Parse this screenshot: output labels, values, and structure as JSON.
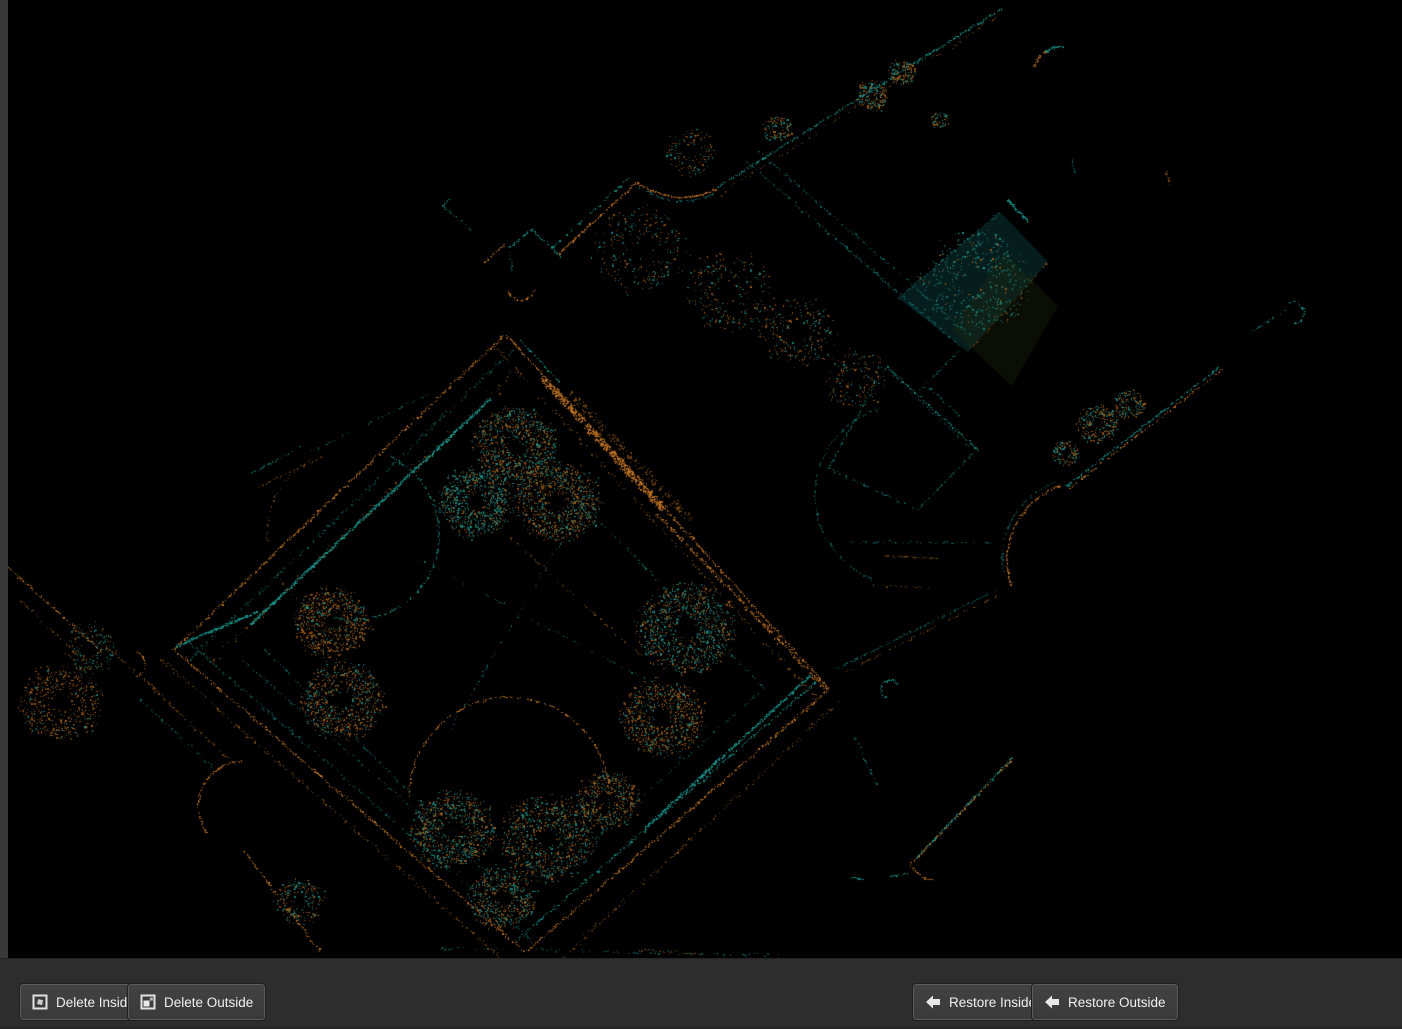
{
  "window": {
    "width": 1402,
    "height": 1029,
    "background": "#000000"
  },
  "chrome": {
    "left_strip_color": "#383838",
    "bottom_bar_color": "#2d2d2d"
  },
  "toolbar": {
    "buttons": [
      {
        "id": "delete-inside",
        "label": "Delete Inside",
        "icon": "segment-delete-inside-icon",
        "x": 20
      },
      {
        "id": "delete-outside",
        "label": "Delete Outside",
        "icon": "segment-delete-outside-icon",
        "x": 128
      },
      {
        "id": "restore-inside",
        "label": "Restore Inside",
        "icon": "arrow-left-icon",
        "x": 913
      },
      {
        "id": "restore-outside",
        "label": "Restore Outside",
        "icon": "arrow-left-icon",
        "x": 1032
      }
    ]
  },
  "viewport": {
    "description": "Top-down LiDAR point cloud of a courtyard building complex, points colored teal and orange on black",
    "accent_teal": "#17988f",
    "accent_orange": "#c07322"
  },
  "scene": {
    "seed": 1337,
    "palette": {
      "T": "#17988f",
      "t": "#0d6966",
      "O": "#c07322",
      "o": "#7c4a12",
      "blob_teal": "#1b8e86",
      "blob_orange": "#a55f16"
    },
    "fills": [
      {
        "poly": [
          [
            1000,
            212
          ],
          [
            1048,
            262
          ],
          [
            968,
            352
          ],
          [
            898,
            298
          ]
        ],
        "color": "rgba(10,55,52,0.55)"
      },
      {
        "poly": [
          [
            1004,
            252
          ],
          [
            1058,
            306
          ],
          [
            1012,
            386
          ],
          [
            952,
            330
          ]
        ],
        "color": "rgba(35,45,18,0.30)"
      }
    ],
    "strokes": [
      [
        "L",
        503,
        336,
        174,
        649,
        "O",
        1,
        0.7,
        1.5
      ],
      [
        "L",
        513,
        349,
        188,
        661,
        "t",
        1,
        0.4,
        2.5
      ],
      [
        "L",
        490,
        399,
        251,
        624,
        "T",
        2,
        0.95,
        0.8
      ],
      [
        "L",
        176,
        646,
        257,
        612,
        "T",
        2,
        0.9,
        0.8
      ],
      [
        "L",
        522,
        365,
        205,
        668,
        "o",
        1,
        0.25,
        5
      ],
      [
        "L",
        506,
        334,
        829,
        689,
        "O",
        1,
        0.75,
        1.2
      ],
      [
        "L",
        542,
        377,
        663,
        509,
        "O",
        6,
        0.8,
        2.5
      ],
      [
        "L",
        570,
        392,
        690,
        520,
        "o",
        4,
        0.45,
        4
      ],
      [
        "L",
        655,
        512,
        827,
        690,
        "O",
        2,
        0.6,
        2
      ],
      [
        "L",
        494,
        346,
        816,
        698,
        "o",
        1,
        0.3,
        3
      ],
      [
        "L",
        518,
        338,
        560,
        383,
        "T",
        1,
        0.5,
        1
      ],
      [
        "L",
        829,
        689,
        527,
        951,
        "O",
        1.2,
        0.7,
        1.5
      ],
      [
        "L",
        817,
        681,
        516,
        941,
        "T",
        1.2,
        0.55,
        1.5
      ],
      [
        "L",
        840,
        701,
        562,
        958,
        "o",
        1,
        0.4,
        2.5
      ],
      [
        "L",
        810,
        676,
        645,
        828,
        "T",
        2,
        0.85,
        0.8
      ],
      [
        "L",
        173,
        649,
        524,
        951,
        "O",
        1.2,
        0.7,
        1.5
      ],
      [
        "L",
        186,
        640,
        532,
        941,
        "t",
        1,
        0.45,
        2
      ],
      [
        "L",
        161,
        659,
        500,
        957,
        "o",
        1,
        0.45,
        2.5
      ],
      [
        "L",
        240,
        658,
        500,
        884,
        "t",
        1,
        0.35,
        1.5
      ],
      [
        "L",
        764,
        688,
        523,
        903,
        "t",
        1,
        0.25,
        1
      ],
      [
        "L",
        523,
        903,
        263,
        648,
        "t",
        1,
        0.25,
        1
      ],
      [
        "L",
        493,
        413,
        764,
        688,
        "t",
        1,
        0.3,
        1
      ],
      [
        "L",
        478,
        508,
        640,
        655,
        "o",
        1,
        0.25,
        1.5
      ],
      [
        "L",
        600,
        475,
        450,
        730,
        "t",
        1,
        0.18,
        1.5
      ],
      [
        "L",
        420,
        560,
        690,
        703,
        "t",
        1,
        0.18,
        1.5
      ],
      [
        "A",
        353,
        534,
        86,
        -65,
        125,
        "T",
        1.5,
        0.5
      ],
      [
        "A",
        353,
        534,
        86,
        125,
        240,
        "o",
        1,
        0.25
      ],
      [
        "A",
        509,
        797,
        100,
        180,
        355,
        "O",
        1.2,
        0.5
      ],
      [
        "A",
        509,
        797,
        100,
        0,
        40,
        "t",
        1,
        0.3
      ],
      [
        "A",
        905,
        495,
        90,
        110,
        255,
        "t",
        1,
        0.35
      ],
      [
        "A",
        243,
        806,
        45,
        140,
        270,
        "O",
        1.5,
        0.65
      ],
      [
        "A",
        890,
        689,
        9,
        120,
        330,
        "T",
        1.5,
        0.8
      ],
      [
        "A",
        1060,
        73,
        26,
        195,
        237,
        "O",
        2,
        0.8
      ],
      [
        "A",
        1060,
        73,
        26,
        237,
        277,
        "T",
        2,
        0.8
      ],
      [
        "A",
        1293,
        313,
        11,
        250,
        440,
        "T",
        1.2,
        0.7
      ],
      [
        "A",
        132,
        664,
        13,
        280,
        440,
        "O",
        1,
        0.6
      ],
      [
        "A",
        935,
        854,
        26,
        95,
        160,
        "O",
        1.5,
        0.75
      ],
      [
        "L",
        558,
        254,
        636,
        183,
        "O",
        1.5,
        0.85,
        0.8
      ],
      [
        "L",
        552,
        248,
        629,
        178,
        "T",
        1,
        0.5,
        1
      ],
      [
        "Q",
        637,
        183,
        678,
        208,
        716,
        189,
        "O",
        1.5,
        0.85
      ],
      [
        "Q",
        639,
        187,
        679,
        212,
        714,
        193,
        "t",
        1,
        0.4
      ],
      [
        "L",
        716,
        188,
        1004,
        7,
        "T",
        1.2,
        0.65,
        1
      ],
      [
        "L",
        720,
        194,
        1000,
        15,
        "o",
        1,
        0.2,
        2.5
      ],
      [
        "L",
        533,
        231,
        561,
        256,
        "T",
        1.5,
        0.7,
        0.8
      ],
      [
        "L",
        533,
        228,
        509,
        248,
        "T",
        1,
        0.6,
        0.8
      ],
      [
        "L",
        509,
        248,
        512,
        270,
        "t",
        1,
        0.5,
        0.8
      ],
      [
        "L",
        483,
        263,
        504,
        245,
        "O",
        1,
        0.6,
        0.8
      ],
      [
        "A",
        521,
        286,
        14,
        20,
        160,
        "O",
        1.2,
        0.7
      ],
      [
        "L",
        443,
        206,
        472,
        231,
        "t",
        1,
        0.5,
        1.2
      ],
      [
        "L",
        449,
        199,
        443,
        206,
        "T",
        1.5,
        0.7,
        0.5
      ],
      [
        "L",
        746,
        161,
        962,
        348,
        "t",
        1,
        0.5,
        1.2
      ],
      [
        "L",
        758,
        151,
        974,
        338,
        "t",
        1,
        0.4,
        1.2
      ],
      [
        "L",
        962,
        348,
        915,
        395,
        "t",
        1,
        0.4,
        1
      ],
      [
        "L",
        886,
        366,
        977,
        449,
        "T",
        1,
        0.55,
        1
      ],
      [
        "L",
        977,
        449,
        917,
        510,
        "t",
        1,
        0.5,
        1
      ],
      [
        "L",
        917,
        510,
        828,
        468,
        "t",
        1,
        0.45,
        1
      ],
      [
        "L",
        828,
        468,
        886,
        366,
        "t",
        1,
        0.5,
        1
      ],
      [
        "L",
        893,
        374,
        968,
        446,
        "t",
        1,
        0.3,
        1
      ],
      [
        "L",
        1221,
        366,
        1066,
        486,
        "T",
        1.2,
        0.7,
        0.8
      ],
      [
        "L",
        1223,
        369,
        1068,
        489,
        "O",
        1,
        0.5,
        0.8
      ],
      [
        "A",
        1085,
        560,
        78,
        160,
        252,
        "O",
        1.5,
        0.7
      ],
      [
        "A",
        1082,
        558,
        80,
        170,
        250,
        "t",
        1,
        0.4
      ],
      [
        "L",
        838,
        668,
        998,
        589,
        "t",
        1,
        0.5,
        1
      ],
      [
        "L",
        843,
        673,
        1000,
        594,
        "o",
        1,
        0.3,
        1
      ],
      [
        "L",
        850,
        542,
        992,
        543,
        "t",
        1,
        0.3,
        1
      ],
      [
        "L",
        884,
        556,
        938,
        558,
        "o",
        1,
        0.45,
        0.8
      ],
      [
        "L",
        873,
        585,
        932,
        588,
        "o",
        1,
        0.35,
        0.8
      ],
      [
        "L",
        1013,
        757,
        916,
        858,
        "T",
        1.2,
        0.75,
        0.8
      ],
      [
        "L",
        1011,
        760,
        914,
        861,
        "O",
        1,
        0.5,
        0.8
      ],
      [
        "L",
        888,
        877,
        908,
        873,
        "T",
        1.2,
        0.7,
        0.5
      ],
      [
        "L",
        852,
        877,
        863,
        879,
        "T",
        1.2,
        0.8,
        0.4
      ],
      [
        "L",
        855,
        737,
        878,
        788,
        "t",
        1,
        0.4,
        1
      ],
      [
        "L",
        8,
        567,
        102,
        652,
        "O",
        1,
        0.6,
        1.2
      ],
      [
        "L",
        20,
        600,
        90,
        668,
        "o",
        1,
        0.4,
        1.5
      ],
      [
        "L",
        100,
        641,
        170,
        702,
        "o",
        1,
        0.4,
        1.5
      ],
      [
        "L",
        150,
        686,
        232,
        762,
        "o",
        1,
        0.45,
        1.5
      ],
      [
        "L",
        140,
        700,
        212,
        766,
        "t",
        1,
        0.3,
        1.5
      ],
      [
        "L",
        244,
        851,
        320,
        952,
        "O",
        1.2,
        0.6,
        1
      ],
      [
        "L",
        252,
        473,
        300,
        447,
        "t",
        1,
        0.45,
        1
      ],
      [
        "L",
        258,
        487,
        322,
        457,
        "o",
        1,
        0.35,
        1
      ],
      [
        "L",
        310,
        452,
        428,
        394,
        "t",
        1,
        0.25,
        1.5
      ],
      [
        "L",
        432,
        948,
        778,
        955,
        "t",
        1,
        0.22,
        2
      ],
      [
        "L",
        640,
        950,
        700,
        954,
        "o",
        1,
        0.4,
        1.5
      ],
      [
        "L",
        1000,
        212,
        898,
        298,
        "t",
        1,
        0.4,
        1
      ],
      [
        "L",
        1008,
        200,
        1028,
        221,
        "T",
        2,
        0.85,
        0.6
      ],
      [
        "L",
        1048,
        262,
        968,
        352,
        "o",
        1,
        0.25,
        1.5
      ],
      [
        "L",
        1072,
        160,
        1075,
        172,
        "t",
        1,
        0.7,
        0.5
      ],
      [
        "L",
        1166,
        172,
        1170,
        184,
        "o",
        1,
        0.7,
        0.5
      ],
      [
        "L",
        1253,
        331,
        1289,
        308,
        "t",
        1,
        0.4,
        0.8
      ],
      [
        "L",
        930,
        388,
        960,
        416,
        "t",
        1,
        0.4,
        1
      ]
    ],
    "blobs": [
      [
        516,
        446,
        40,
        0.45,
        900
      ],
      [
        476,
        502,
        36,
        0.75,
        800
      ],
      [
        558,
        502,
        40,
        0.35,
        900
      ],
      [
        686,
        628,
        46,
        0.6,
        1000
      ],
      [
        662,
        718,
        40,
        0.25,
        800
      ],
      [
        332,
        622,
        36,
        0.22,
        700
      ],
      [
        342,
        700,
        40,
        0.3,
        750
      ],
      [
        60,
        702,
        40,
        0.15,
        500
      ],
      [
        452,
        830,
        40,
        0.5,
        800
      ],
      [
        548,
        838,
        45,
        0.45,
        850
      ],
      [
        608,
        800,
        30,
        0.3,
        450
      ],
      [
        502,
        898,
        32,
        0.5,
        500
      ],
      [
        1098,
        424,
        20,
        0.5,
        260
      ],
      [
        1130,
        404,
        15,
        0.45,
        160
      ],
      [
        1066,
        453,
        13,
        0.5,
        130
      ],
      [
        872,
        96,
        16,
        0.4,
        200
      ],
      [
        902,
        72,
        13,
        0.45,
        150
      ],
      [
        940,
        120,
        9,
        0.5,
        60
      ],
      [
        640,
        250,
        45,
        0.5,
        260
      ],
      [
        730,
        292,
        42,
        0.45,
        240
      ],
      [
        798,
        332,
        36,
        0.4,
        220
      ],
      [
        855,
        378,
        30,
        0.4,
        160
      ],
      [
        690,
        152,
        24,
        0.5,
        120
      ],
      [
        975,
        282,
        52,
        0.8,
        420
      ],
      [
        300,
        902,
        24,
        0.6,
        200
      ],
      [
        90,
        648,
        26,
        0.6,
        160
      ],
      [
        778,
        128,
        14,
        0.4,
        120
      ]
    ]
  }
}
